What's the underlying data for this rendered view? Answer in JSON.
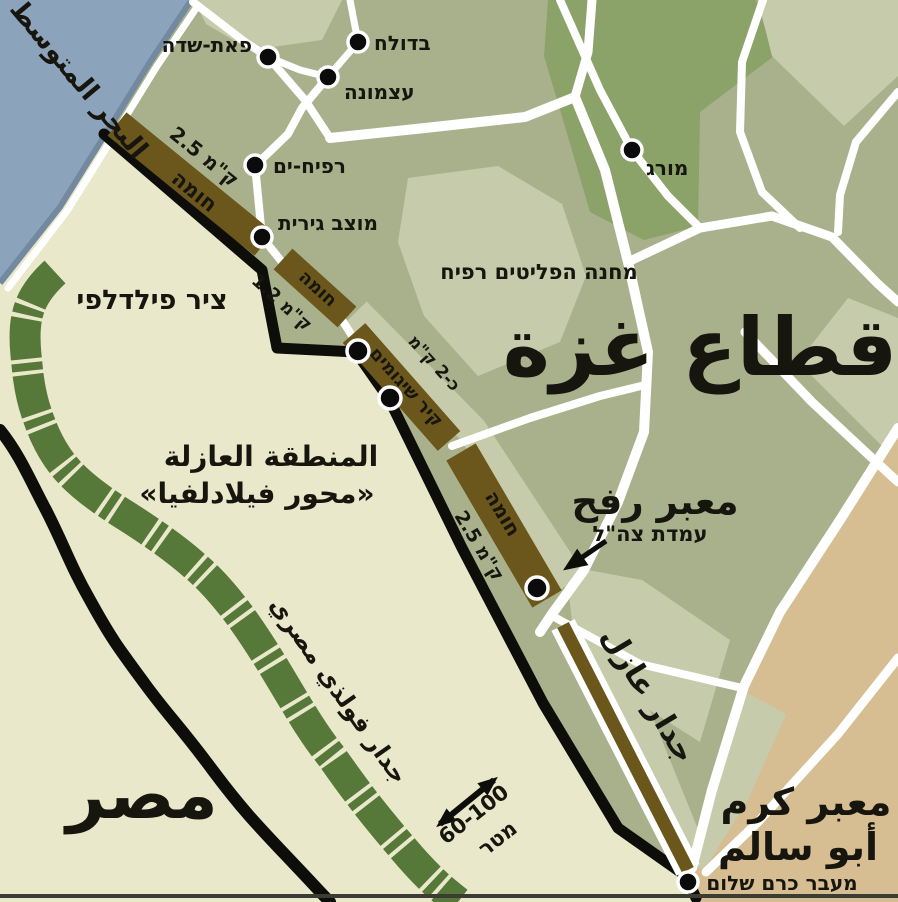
{
  "palette": {
    "sea": "#8ba3bb",
    "sea_edge": "#72899f",
    "gaza_land": "#a9b18c",
    "egypt_land": "#eae8ca",
    "israel_land": "#d6bd92",
    "light_patch": "#c6cbac",
    "dark_patch": "#8ba269",
    "road": "#ffffff",
    "border_line": "#0d0d0a",
    "wall_brown": "#6b561b",
    "steel_wall_green": "#567838",
    "pale_label": "#e9eac0"
  },
  "labels": {
    "sea": "البحر المتوسط",
    "gaza": "قطاع غزة",
    "egypt": "مصر",
    "philadelphi_route": "ציר פילדלפי",
    "buffer_zone_line1": "المنطقة العازلة",
    "buffer_zone_line2": "«محور فيلادلفيا»",
    "egyptian_steel_wall": "جدار فولذي مصري",
    "separation_wall": "جدار عازل",
    "rafah_crossing": "معبر رفح",
    "idf_position": "עמדת צה\"ל",
    "kerem_abu_salem_line1": "معبر كرم",
    "kerem_abu_salem_line2": "أبو سالم",
    "kerem_shalom": "מעבר כרם שלום",
    "refugee_camp": "מחנה הפליטים רפיח",
    "distance_range": "60-100",
    "distance_unit": "מטר"
  },
  "settlements": [
    {
      "name": "בדולח"
    },
    {
      "name": "פאת-שדה"
    },
    {
      "name": "עצמונה"
    },
    {
      "name": "רפיח-ים"
    },
    {
      "name": "מוצב גירית"
    },
    {
      "name": "מורג"
    }
  ],
  "walls": [
    {
      "label": "חומה",
      "length": "ק\"מ 2.5"
    },
    {
      "label": "חומה",
      "length": "ק\"מ 1.2"
    },
    {
      "label": "קיר שיגומים",
      "length": "כ-2 ק\"מ"
    },
    {
      "label": "חומה",
      "length": "ק\"מ 2.5"
    }
  ]
}
